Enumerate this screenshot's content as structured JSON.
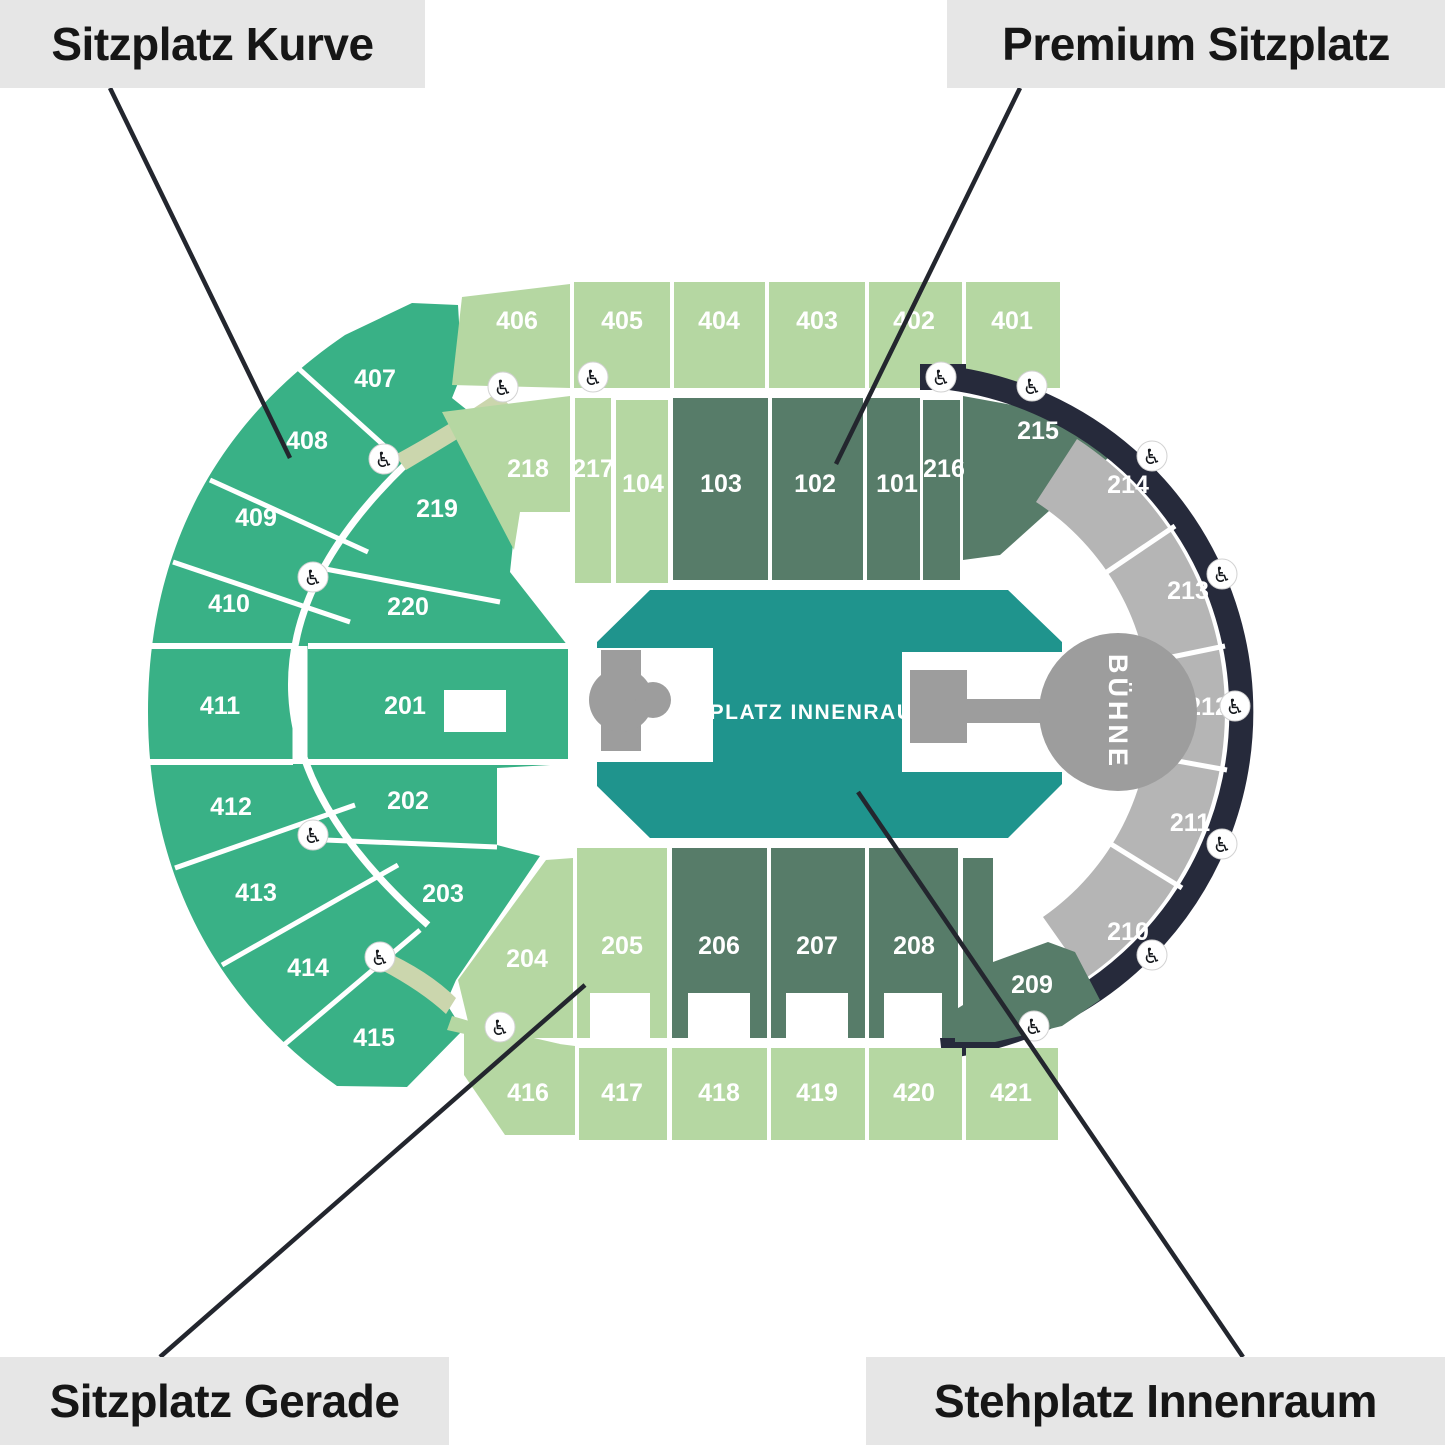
{
  "legend": {
    "top_left": {
      "label": "Sitzplatz Kurve"
    },
    "top_right": {
      "label": "Premium Sitzplatz"
    },
    "bottom_left": {
      "label": "Sitzplatz Gerade"
    },
    "bottom_right": {
      "label": "Stehplatz Innenraum"
    }
  },
  "map": {
    "standing_area": {
      "label": "STEHPLATZ INNENRAUM"
    },
    "stage": {
      "label": "BÜHNE"
    },
    "colors": {
      "sitzplatz_gerade_light": "#b5d7a2",
      "sitzplatz_kurve_green": "#39b186",
      "premium_dark_green": "#577c69",
      "side_gray": "#b5b5b5",
      "standing_teal": "#1f948d",
      "ring_dark": "#262a3b",
      "stage_gray": "#9d9d9d",
      "label_box_bg": "#e6e6e6",
      "label_text": "#161616",
      "leader_line": "#23262e",
      "accessible_path_tan": "#cbd6ad"
    },
    "sections": [
      {
        "label": "406",
        "x": 517,
        "y": 320,
        "group": "gerade"
      },
      {
        "label": "405",
        "x": 622,
        "y": 320,
        "group": "gerade"
      },
      {
        "label": "404",
        "x": 719,
        "y": 320,
        "group": "gerade"
      },
      {
        "label": "403",
        "x": 817,
        "y": 320,
        "group": "gerade"
      },
      {
        "label": "402",
        "x": 914,
        "y": 320,
        "group": "gerade"
      },
      {
        "label": "401",
        "x": 1012,
        "y": 320,
        "group": "gerade"
      },
      {
        "label": "218",
        "x": 528,
        "y": 468,
        "group": "gerade"
      },
      {
        "label": "217",
        "x": 593,
        "y": 468,
        "group": "gerade"
      },
      {
        "label": "104",
        "x": 643,
        "y": 483,
        "group": "gerade"
      },
      {
        "label": "103",
        "x": 721,
        "y": 483,
        "group": "premium"
      },
      {
        "label": "102",
        "x": 815,
        "y": 483,
        "group": "premium"
      },
      {
        "label": "101",
        "x": 897,
        "y": 483,
        "group": "premium"
      },
      {
        "label": "216",
        "x": 944,
        "y": 468,
        "group": "premium"
      },
      {
        "label": "215",
        "x": 1038,
        "y": 430,
        "group": "premium"
      },
      {
        "label": "214",
        "x": 1128,
        "y": 484,
        "group": "side"
      },
      {
        "label": "213",
        "x": 1188,
        "y": 590,
        "group": "side"
      },
      {
        "label": "212",
        "x": 1208,
        "y": 706,
        "group": "side"
      },
      {
        "label": "211",
        "x": 1190,
        "y": 822,
        "group": "side"
      },
      {
        "label": "210",
        "x": 1128,
        "y": 931,
        "group": "side"
      },
      {
        "label": "209",
        "x": 1032,
        "y": 984,
        "group": "premium"
      },
      {
        "label": "208",
        "x": 914,
        "y": 945,
        "group": "premium"
      },
      {
        "label": "207",
        "x": 817,
        "y": 945,
        "group": "premium"
      },
      {
        "label": "206",
        "x": 719,
        "y": 945,
        "group": "premium"
      },
      {
        "label": "205",
        "x": 622,
        "y": 945,
        "group": "gerade"
      },
      {
        "label": "204",
        "x": 527,
        "y": 958,
        "group": "gerade"
      },
      {
        "label": "416",
        "x": 528,
        "y": 1092,
        "group": "gerade"
      },
      {
        "label": "417",
        "x": 622,
        "y": 1092,
        "group": "gerade"
      },
      {
        "label": "418",
        "x": 719,
        "y": 1092,
        "group": "gerade"
      },
      {
        "label": "419",
        "x": 817,
        "y": 1092,
        "group": "gerade"
      },
      {
        "label": "420",
        "x": 914,
        "y": 1092,
        "group": "gerade"
      },
      {
        "label": "421",
        "x": 1011,
        "y": 1092,
        "group": "gerade"
      },
      {
        "label": "407",
        "x": 375,
        "y": 378,
        "group": "kurve"
      },
      {
        "label": "408",
        "x": 307,
        "y": 440,
        "group": "kurve"
      },
      {
        "label": "409",
        "x": 256,
        "y": 517,
        "group": "kurve"
      },
      {
        "label": "410",
        "x": 229,
        "y": 603,
        "group": "kurve"
      },
      {
        "label": "411",
        "x": 220,
        "y": 705,
        "group": "kurve"
      },
      {
        "label": "412",
        "x": 231,
        "y": 806,
        "group": "kurve"
      },
      {
        "label": "413",
        "x": 256,
        "y": 892,
        "group": "kurve"
      },
      {
        "label": "414",
        "x": 308,
        "y": 967,
        "group": "kurve"
      },
      {
        "label": "415",
        "x": 374,
        "y": 1037,
        "group": "kurve"
      },
      {
        "label": "219",
        "x": 437,
        "y": 508,
        "group": "kurve"
      },
      {
        "label": "220",
        "x": 408,
        "y": 606,
        "group": "kurve"
      },
      {
        "label": "201",
        "x": 405,
        "y": 705,
        "group": "kurve"
      },
      {
        "label": "202",
        "x": 408,
        "y": 800,
        "group": "kurve"
      },
      {
        "label": "203",
        "x": 443,
        "y": 893,
        "group": "kurve"
      }
    ],
    "accessibility_icons": {
      "name": "wheelchair-icon",
      "glyph": "♿",
      "positions": [
        {
          "x": 503,
          "y": 387
        },
        {
          "x": 593,
          "y": 377
        },
        {
          "x": 384,
          "y": 459
        },
        {
          "x": 313,
          "y": 577
        },
        {
          "x": 313,
          "y": 835
        },
        {
          "x": 380,
          "y": 957
        },
        {
          "x": 500,
          "y": 1027
        },
        {
          "x": 941,
          "y": 377
        },
        {
          "x": 1032,
          "y": 386
        },
        {
          "x": 1152,
          "y": 456
        },
        {
          "x": 1222,
          "y": 574
        },
        {
          "x": 1235,
          "y": 706
        },
        {
          "x": 1222,
          "y": 844
        },
        {
          "x": 1152,
          "y": 955
        },
        {
          "x": 1034,
          "y": 1026
        }
      ]
    }
  }
}
